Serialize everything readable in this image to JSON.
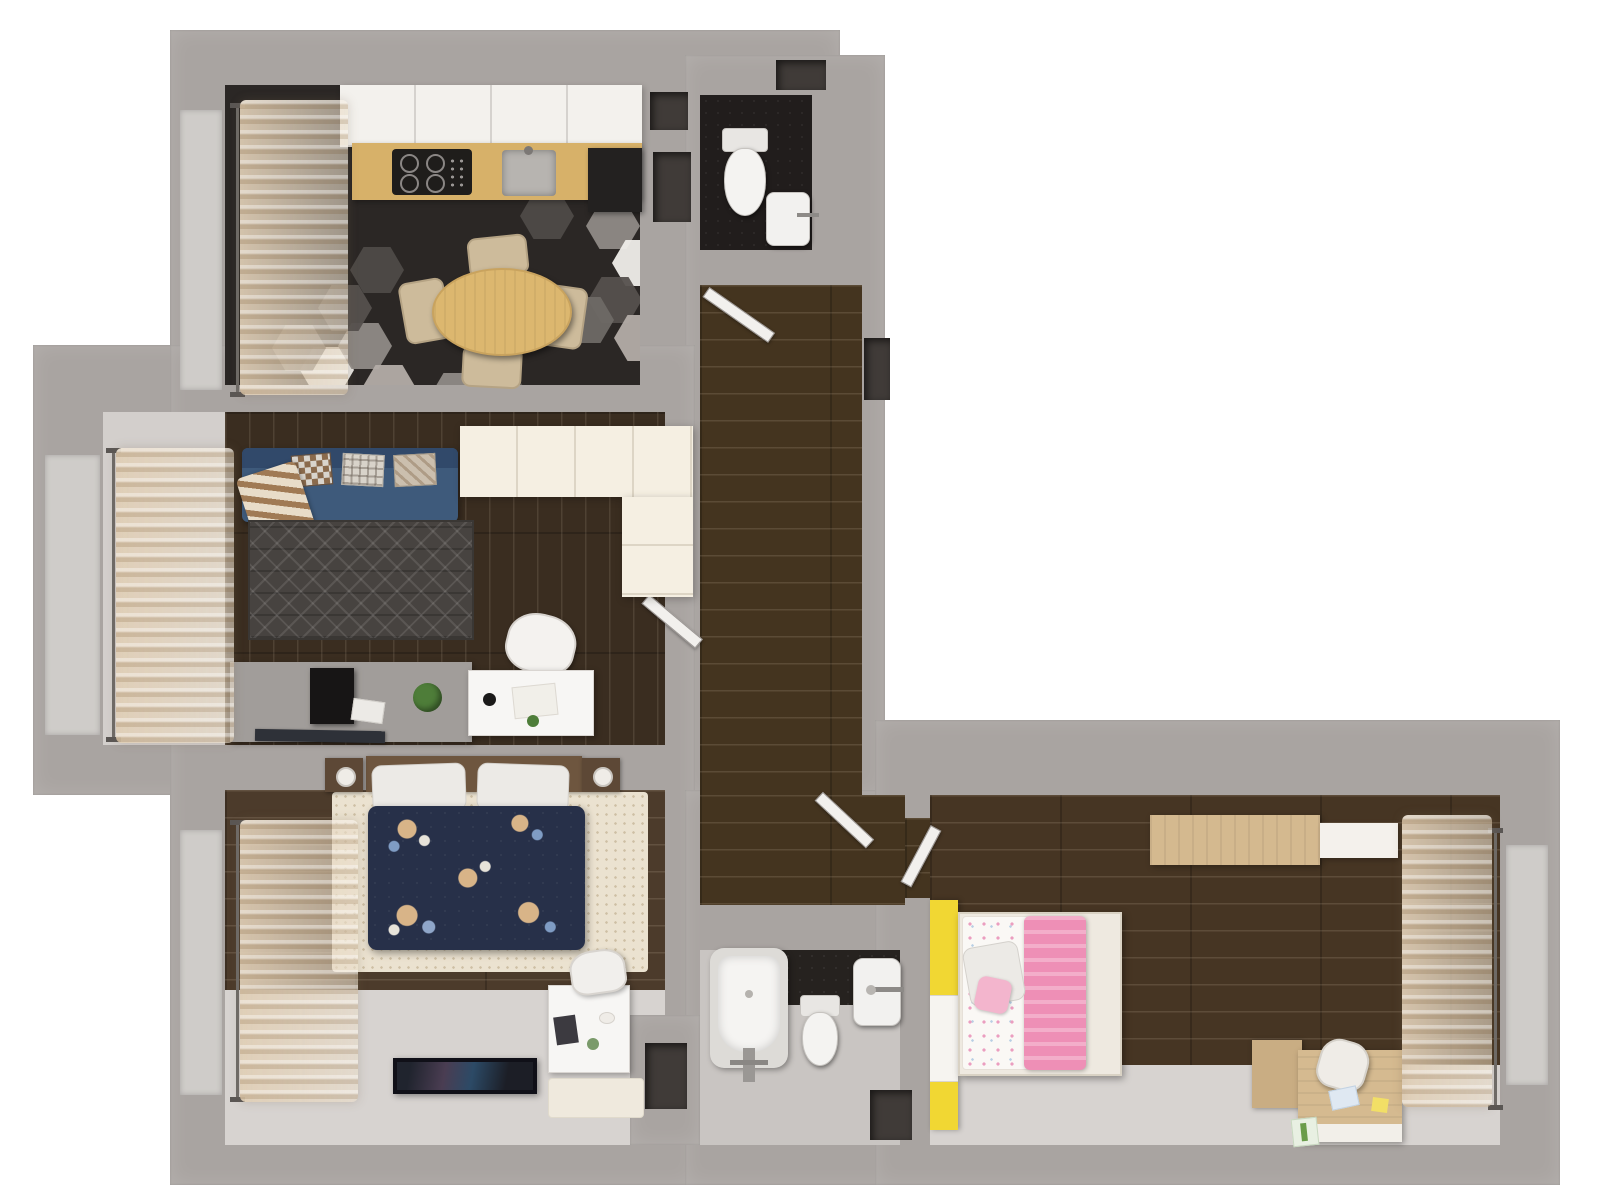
{
  "scene": {
    "kind": "3d-floor-plan-top-down-render",
    "background_color": "#ffffff",
    "text_visible": false
  },
  "palette": {
    "wall": "#a9a4a1",
    "wall_dark": "#8d8885",
    "floor_light": "#d7d3d0",
    "wood_corridor": "#44341f",
    "wood_living": "#3a2d20",
    "wood_bedroom": "#4c3b2b",
    "wood_kids": "#463523",
    "hex_tile_base": "#2b2725",
    "hex_tile_white": "#efede9",
    "hex_tile_gray": "#8f8a86",
    "cream_wardrobe": "#f5efe2",
    "counter_wood": "#d7b169",
    "table_wood": "#dcb76f",
    "chair_beige": "#cdbb9b",
    "sofa_blue": "#3e5a7b",
    "rug_dark": "#474340",
    "rug_cream": "#ebe2d0",
    "duvet_navy": "#273049",
    "kids_pink": "#ee8fb6",
    "kids_yellow": "#f1d733",
    "curtain_beige": "#dbc7ab",
    "plant_green": "#4e7d39"
  },
  "rooms": [
    {
      "id": "kitchen-dining",
      "position": "top-left",
      "floor": "dark hexagon mosaic tile with scattered white/gray tiles",
      "furniture": [
        "upper-cabinet-row",
        "wood-countertop",
        "gas-hob-4-burners",
        "kitchen-sink",
        "dark-fridge",
        "oval-dining-table",
        "dining-chair x4",
        "window-sheer-curtain"
      ]
    },
    {
      "id": "wc",
      "position": "top-middle",
      "floor": "dark tile",
      "furniture": [
        "toilet",
        "wall-hung-sink",
        "vent-shafts"
      ]
    },
    {
      "id": "corridor",
      "position": "center-vertical",
      "floor": "dark wood planks",
      "furniture": [
        "open-door-to-kitchen-side",
        "open-door-to-living-room"
      ]
    },
    {
      "id": "living-room",
      "position": "middle-left",
      "floor": "dark wood planks with window alcove",
      "furniture": [
        "blue-sofa",
        "sofa-pillows x3",
        "plaid-blanket",
        "triangle-pattern-rug",
        "cream-l-shaped-wardrobe",
        "tv-console",
        "desktop-pc",
        "potted-plant",
        "white-desk",
        "desk-chair",
        "floor-magazines",
        "window-sheer-curtain"
      ]
    },
    {
      "id": "master-bedroom",
      "position": "bottom-left",
      "floor": "dark wood planks + light floor, cream fluffy rug",
      "furniture": [
        "double-bed-navy-floral-duvet",
        "white-pillows x2",
        "nightstand x2",
        "table-lamp x2",
        "flat-tv",
        "white-vanity-desk",
        "vanity-chair",
        "small-mat",
        "window-sheer-curtain"
      ]
    },
    {
      "id": "bathroom",
      "position": "bottom-middle",
      "floor": "gray + dark hex tile",
      "furniture": [
        "bathtub",
        "toilet",
        "wall-sink",
        "vent-shaft",
        "entry-niche"
      ]
    },
    {
      "id": "kids-room",
      "position": "right",
      "floor": "dark wood planks + light floor strip",
      "furniture": [
        "yellow-wardrobe",
        "kids-bed-pink-white",
        "pink-blanket",
        "kids-pillow",
        "wall-shelf",
        "wood-desk",
        "desk-cabinet",
        "desk-chair",
        "toys-papers",
        "window-sheer-curtain",
        "open-door"
      ]
    },
    {
      "id": "entry-hall",
      "position": "center-bottom",
      "floor": "dark wood planks",
      "furniture": [
        "open-door-to-bath-lobby",
        "open-door-to-kids-room"
      ]
    }
  ]
}
